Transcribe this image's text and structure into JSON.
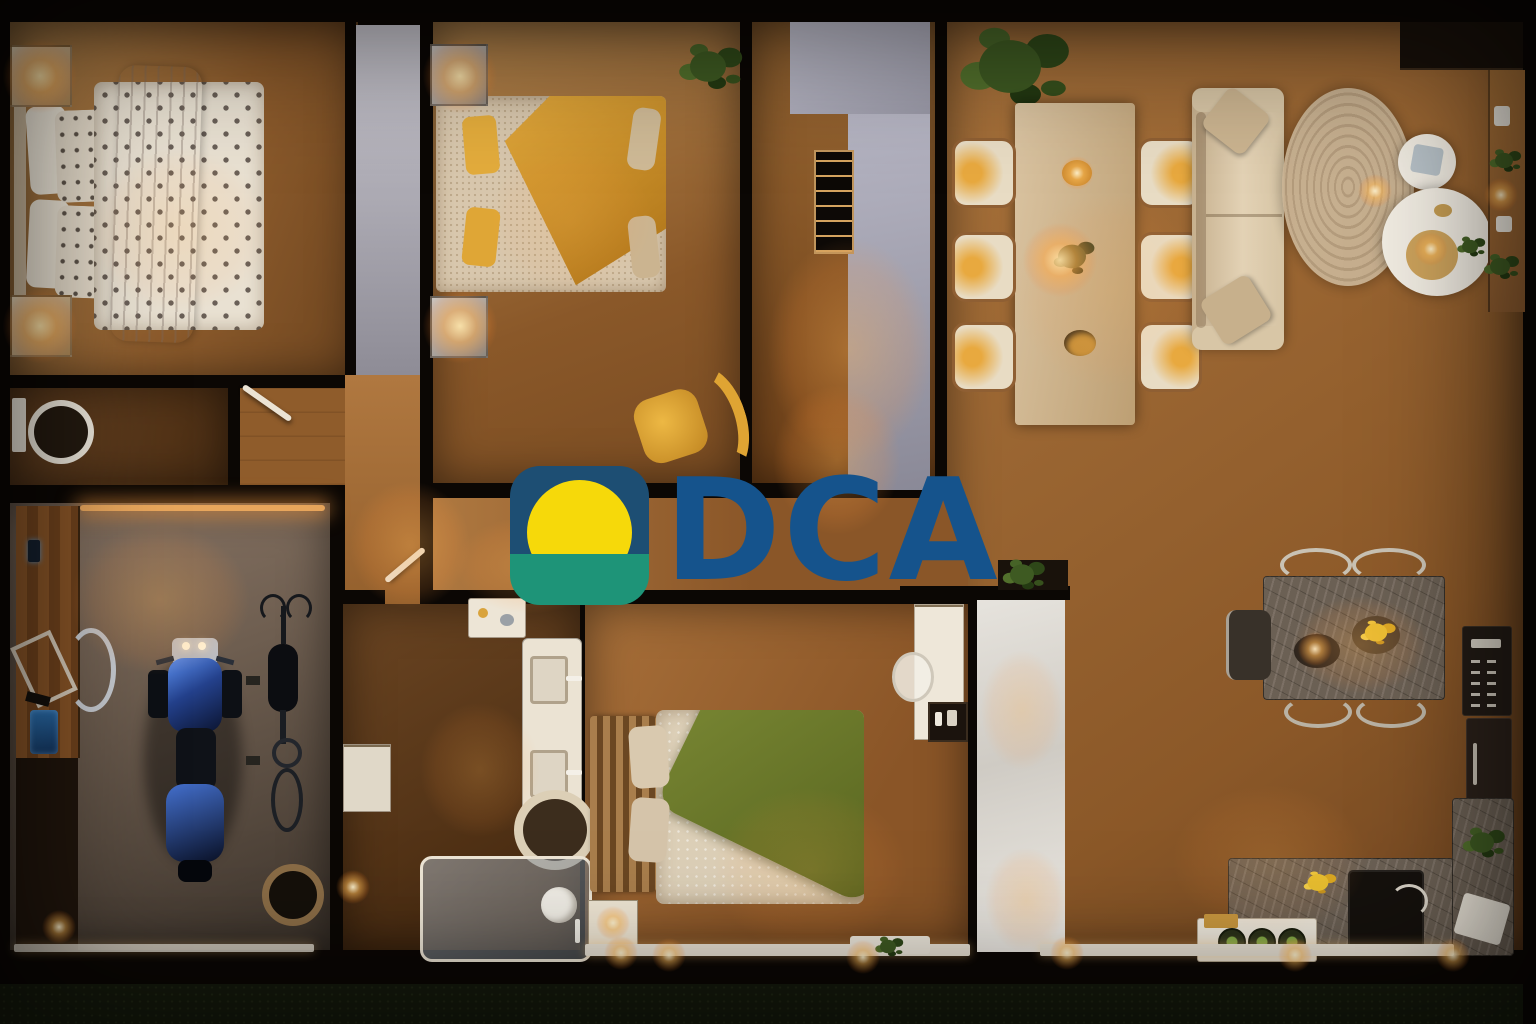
{
  "logo": {
    "text": "DCA",
    "icon": "sunrise-icon",
    "colors": {
      "logo_blue": "#1D4E73",
      "logo_green": "#1E9478",
      "logo_yellow": "#F6D90A",
      "logo_text": "#15538C"
    }
  },
  "palette": {
    "wall": "#0B0704",
    "wood": "#A06A36",
    "wood_dark": "#573619",
    "concrete": "#756759",
    "grass": "#161B0D",
    "partition": "#A9A8B6",
    "white_furniture": "#EAE3D5",
    "marble": "#6B6054",
    "blanket_green": "#6B7A2F",
    "blanket_mustard": "#D1942C",
    "accent_warm": "#FFB45F"
  },
  "scene": {
    "description": "Top-down night render of a furnished apartment floor plan",
    "rooms": [
      "bedroom-1",
      "bedroom-2",
      "entry-hall",
      "living-dining-room",
      "kitchen",
      "toilet",
      "corridor",
      "bathroom",
      "bedroom-3",
      "garage"
    ]
  }
}
